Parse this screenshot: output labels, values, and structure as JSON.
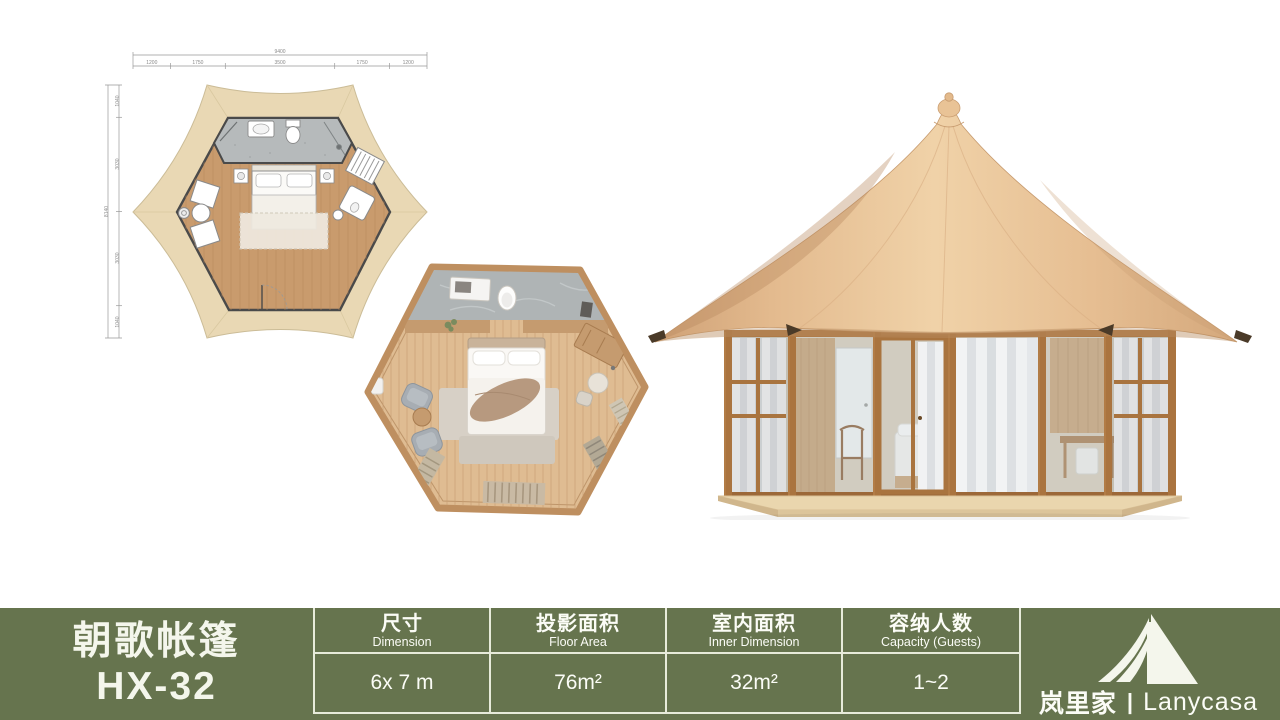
{
  "product": {
    "name_cn": "朝歌帐篷",
    "model": "HX-32"
  },
  "spec_table": {
    "columns": [
      {
        "label_cn": "尺寸",
        "label_en": "Dimension",
        "value": "6x 7 m"
      },
      {
        "label_cn": "投影面积",
        "label_en": "Floor Area",
        "value": "76m²"
      },
      {
        "label_cn": "室内面积",
        "label_en": "Inner Dimension",
        "value": "32m²"
      },
      {
        "label_cn": "容纳人数",
        "label_en": "Capacity (Guests)",
        "value": "1~2"
      }
    ]
  },
  "brand": {
    "name_cn": "岚里家",
    "divider": "|",
    "name_en": "Lanycasa"
  },
  "floorplan_cad": {
    "dims_top": {
      "total": "9400",
      "segments": [
        "1200",
        "1750",
        "3500",
        "1750",
        "1200"
      ]
    },
    "dims_left": {
      "total": "8140",
      "segments": [
        "1040",
        "3030",
        "3030",
        "1040"
      ]
    }
  },
  "colors": {
    "bar_background": "#66744E",
    "table_line": "#E7EBDA",
    "bar_text": "#FBFCF6",
    "canvas_beige": "#E9D8B4",
    "roof_tan": "#E8C094",
    "wood_frame": "#AA743F",
    "wood_floor": "#C99B6D"
  }
}
